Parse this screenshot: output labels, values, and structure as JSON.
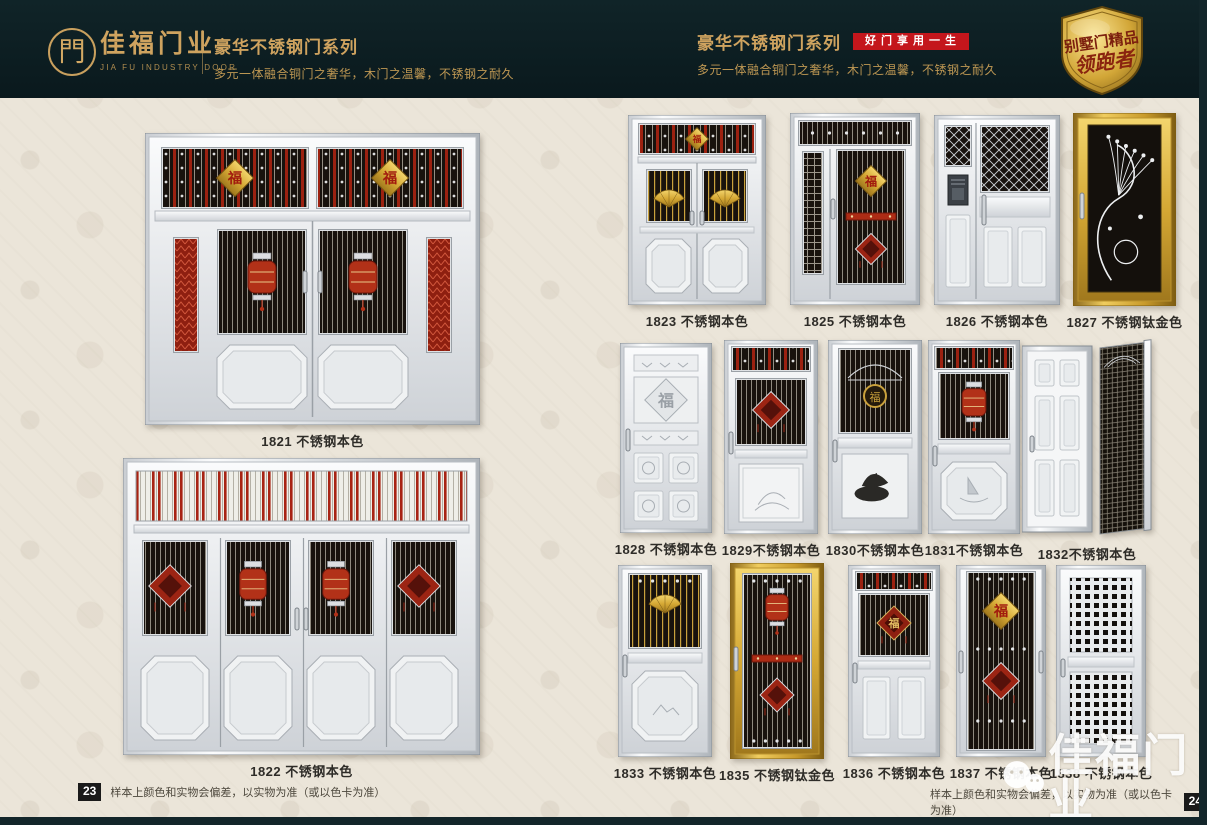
{
  "header_left": {
    "logo_glyph": "門",
    "brand": "佳福门业",
    "brand_sub": "JIA FU INDUSTRY DOOR",
    "series_title": "豪华不锈钢门系列",
    "tagline": "多元一体融合铜门之奢华，木门之温馨，不锈钢之耐久"
  },
  "header_right": {
    "series_title": "豪华不锈钢门系列",
    "badge": "好门享用一生",
    "tagline": "多元一体融合铜门之奢华，木门之温馨，不锈钢之耐久",
    "emblem_line1": "别墅门精品",
    "emblem_line2": "领跑者"
  },
  "left_page": {
    "page_number": "23",
    "disclaimer": "样本上颜色和实物会偏差，以实物为准（或以色卡为准）",
    "doors": [
      {
        "id": "1821",
        "label": "1821 不锈钢本色"
      },
      {
        "id": "1822",
        "label": "1822 不锈钢本色"
      }
    ]
  },
  "right_page": {
    "page_number": "24",
    "disclaimer": "样本上颜色和实物会偏差，以实物为准（或以色卡为准）",
    "doors": [
      {
        "id": "1823",
        "label": "1823 不锈钢本色"
      },
      {
        "id": "1825",
        "label": "1825 不锈钢本色"
      },
      {
        "id": "1826",
        "label": "1826 不锈钢本色"
      },
      {
        "id": "1827",
        "label": "1827 不锈钢钛金色"
      },
      {
        "id": "1828",
        "label": "1828 不锈钢本色"
      },
      {
        "id": "1829",
        "label": "1829不锈钢本色"
      },
      {
        "id": "1830",
        "label": "1830不锈钢本色"
      },
      {
        "id": "1831",
        "label": "1831不锈钢本色"
      },
      {
        "id": "1832",
        "label": "1832不锈钢本色"
      },
      {
        "id": "1833",
        "label": "1833 不锈钢本色"
      },
      {
        "id": "1835",
        "label": "1835 不锈钢钛金色"
      },
      {
        "id": "1836",
        "label": "1836 不锈钢本色"
      },
      {
        "id": "1837",
        "label": "1837 不锈钢本色"
      },
      {
        "id": "1838",
        "label": "1838 不锈钢本色"
      }
    ]
  },
  "watermark": {
    "text": "佳福门业"
  }
}
